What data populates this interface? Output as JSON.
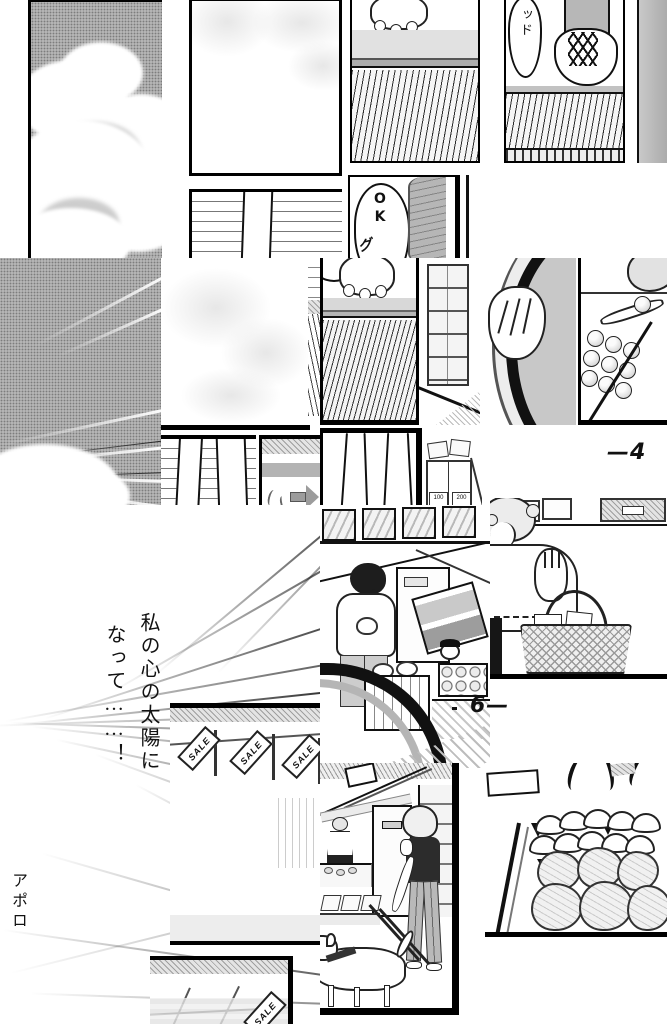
{
  "manga": {
    "speech": {
      "shoe_bubble": "ッド",
      "ok_bubble": "OK",
      "sfx_grip": "グ"
    },
    "monologue": {
      "line1": "私の心の太陽に",
      "line2": "なって……！"
    },
    "sfx": {
      "apollo": "アポロ"
    },
    "page_numbers": {
      "upper": "—4",
      "lower": "6—"
    },
    "labels": {
      "sale": "SALE",
      "price_left": "100",
      "price_right": "200"
    },
    "colors": {
      "paper": "#ffffff",
      "ink": "#111111",
      "halftone_dark": "#b4b4b4",
      "halftone_light": "#e7e7e7"
    }
  }
}
